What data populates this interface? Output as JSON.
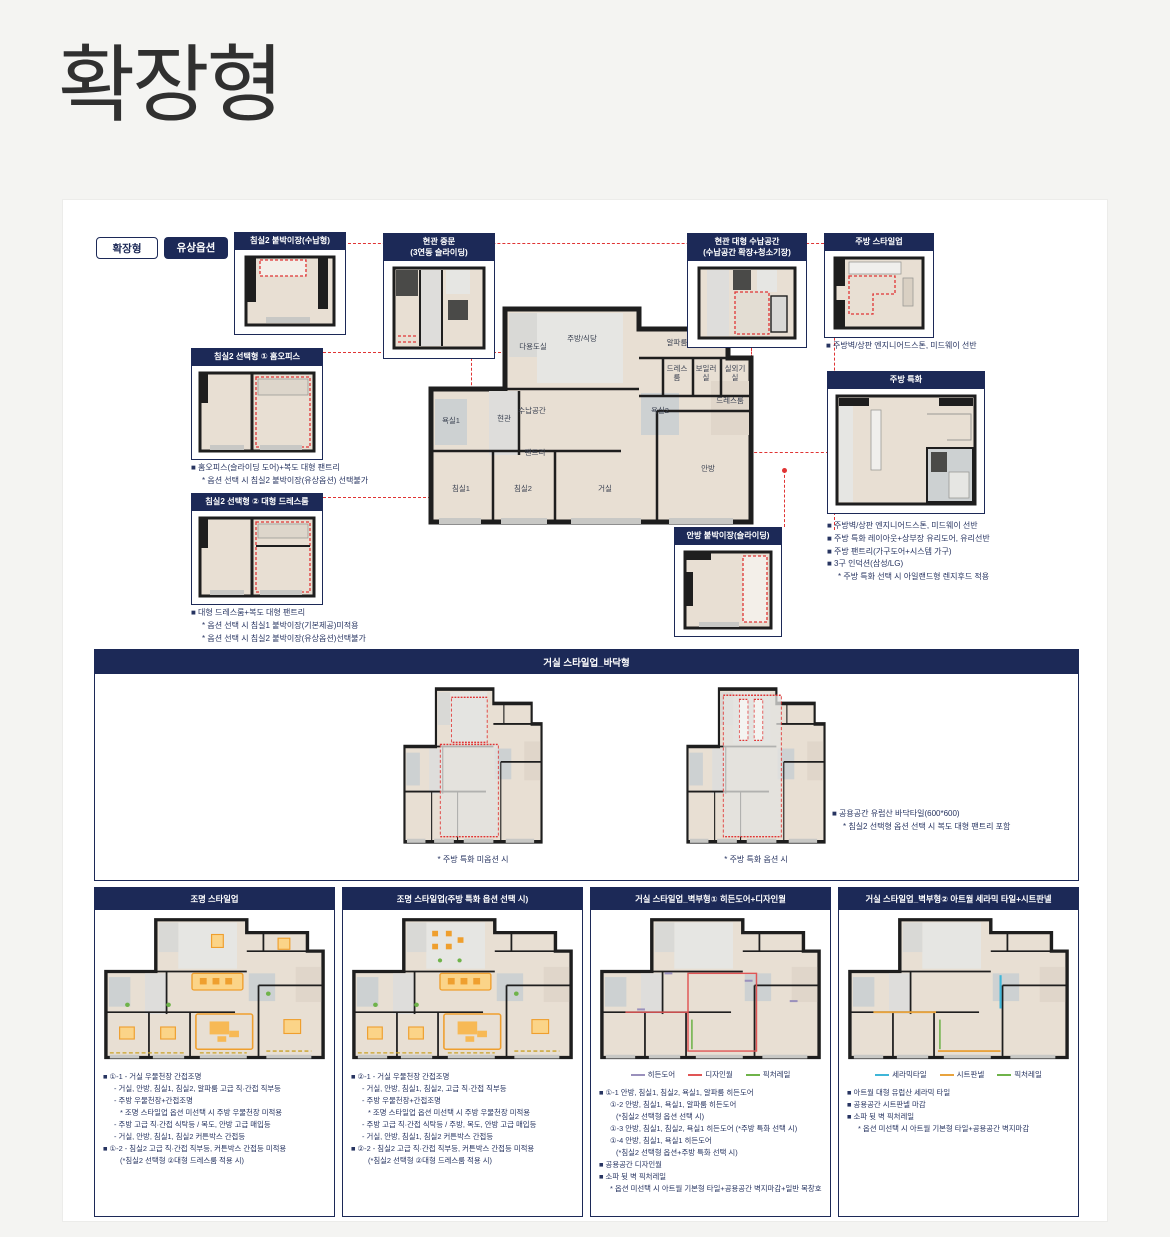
{
  "page": {
    "title": "확장형"
  },
  "top": {
    "badge_type": "확장형",
    "badge_option": "유상옵션",
    "callouts": {
      "bed2_closet": {
        "title": "침실2 붙박이장(수납형)"
      },
      "bed2_opt1": {
        "title": "침실2 선택형 ① 홈오피스",
        "notes": [
          "■ 홈오피스(슬라이딩 도어)+복도 대형 팬트리",
          "* 옵션 선택 시 침실2 붙박이장(유상옵션) 선택불가"
        ]
      },
      "bed2_opt2": {
        "title": "침실2 선택형 ② 대형 드레스룸",
        "notes": [
          "■ 대형 드레스룸+복도 대형 팬트리",
          "* 옵션 선택 시 침실1 붙박이장(기본제공)미적용",
          "* 옵션 선택 시 침실2 붙박이장(유상옵션)선택불가"
        ]
      },
      "entry_door": {
        "title1": "현관 중문",
        "title2": "(3연동 슬라이딩)"
      },
      "entry_storage": {
        "title1": "현관 대형 수납공간",
        "title2": "(수납공간 확장+청소기장)"
      },
      "kitchen_styleup": {
        "title": "주방 스타일업",
        "notes": [
          "■ 주방벽/상판 엔지니어드스톤, 미드웨이 선반"
        ]
      },
      "kitchen_special": {
        "title": "주방 특화",
        "notes": [
          "■ 주방벽/상판 엔지니어드스톤, 미드웨이 선반",
          "■ 주방 특화 레이아웃+상부장 유리도어, 유리선반",
          "■ 주방 팬트리(가구도어+시스템 가구)",
          "■ 3구 인덕션(삼성/LG)",
          "* 주방 특화 선택 시 아일랜드형 렌지후드 적용"
        ]
      },
      "master_closet": {
        "title": "안방 붙박이장(슬라이딩)"
      }
    },
    "plan_rooms": {
      "utility": "다용도실",
      "kitchen": "주방/식당",
      "alpha": "알파룸",
      "dress_top": "드레스룸",
      "boiler": "보일러실",
      "ac": "실외기실",
      "entry": "현관",
      "storage": "수납공간",
      "pantry": "팬트리",
      "bath1": "욕실1",
      "bath2": "욕실2",
      "dress_right": "드레스룸",
      "bed1": "침실1",
      "bed2": "침실2",
      "living": "거실",
      "master": "안방"
    }
  },
  "floor_section": {
    "header": "거실 스타일업_바닥형",
    "caption_left": "* 주방 특화 미옵션 시",
    "caption_right": "* 주방 특화 옵션 시",
    "notes": [
      "■ 공용공간 유럽산 바닥타일(600*600)",
      "* 침실2 선택형 옵션 선택 시 복도 대형 팬트리 포함"
    ]
  },
  "panels": [
    {
      "header": "조명 스타일업",
      "notes": [
        "■ ①-1 - 거실 우물천장 간접조명",
        "- 거실, 안방, 침실1, 침실2, 알파룸 고급 직·간접 직부등",
        "- 주방 우물천장+간접조명",
        "* 조명 스타일업 옵션 미선택 시 주방 우물천장 미적용",
        "- 주방 고급 직·간접 식탁등 / 복도, 안방 고급 매입등",
        "- 거실, 안방, 침실1, 침실2 커튼박스 간접등",
        "■ ①-2 - 침실2 고급 직·간접 직부등, 커튼박스 간접등 미적용",
        "(*침실2 선택형 ②대형 드레스룸 적용 시)"
      ]
    },
    {
      "header": "조명 스타일업(주방 특화 옵션 선택 시)",
      "notes": [
        "■ ②-1 - 거실 우물천장 간접조명",
        "- 거실, 안방, 침실1, 침실2, 고급 직·간접 직부등",
        "- 주방 우물천장+간접조명",
        "* 조명 스타일업 옵션 미선택 시 주방 우물천장 미적용",
        "- 주방 고급 직·간접 식탁등 / 주방, 복도, 안방 고급 매입등",
        "- 거실, 안방, 침실1, 침실2 커튼박스 간접등",
        "■ ②-2 - 침실2 고급 직·간접 직부등, 커튼박스 간접등 미적용",
        "(*침실2 선택형 ②대형 드레스룸 적용 시)"
      ]
    },
    {
      "header": "거실 스타일업_벽부형① 히든도어+디자인월",
      "legend": [
        {
          "label": "히든도어",
          "color": "#9a90bc"
        },
        {
          "label": "디자인월",
          "color": "#e05555"
        },
        {
          "label": "픽처레일",
          "color": "#6fb34a"
        }
      ],
      "notes": [
        "■ ①-1 안방, 침실1, 침실2, 욕실1, 알파룸 히든도어",
        "①-2 안방, 침실1, 욕실1, 알파룸 히든도어",
        "(*침실2 선택형 옵션 선택 시)",
        "①-3 안방, 침실1, 침실2, 욕실1 히든도어 (*주방 특화 선택 시)",
        "①-4 안방, 침실1, 욕실1 히든도어",
        "(*침실2 선택형 옵션+주방 특화 선택 시)",
        "■ 공용공간 디자인월",
        "■ 소파 뒷 벽 픽처레일",
        "* 옵션 미선택 시 아트월 기본형 타일+공용공간 벽지마감+일반 목창호"
      ]
    },
    {
      "header": "거실 스타일업_벽부형② 아트월 세라믹 타일+시트판넬",
      "legend": [
        {
          "label": "세라믹타일",
          "color": "#3fb6d8"
        },
        {
          "label": "시트판넬",
          "color": "#e8a33d"
        },
        {
          "label": "픽처레일",
          "color": "#6fb34a"
        }
      ],
      "notes": [
        "■ 아트월 대형 유럽산 세라믹 타일",
        "■ 공용공간 시트판넬 마감",
        "■ 소파 뒷 벽 픽처레일",
        "* 옵션 미선택 시 아트월 기본형 타일+공용공간 벽지마감"
      ]
    }
  ],
  "colors": {
    "navy": "#1c2957",
    "leader_red": "#e03434",
    "light_orange": "#ef9f2e"
  }
}
